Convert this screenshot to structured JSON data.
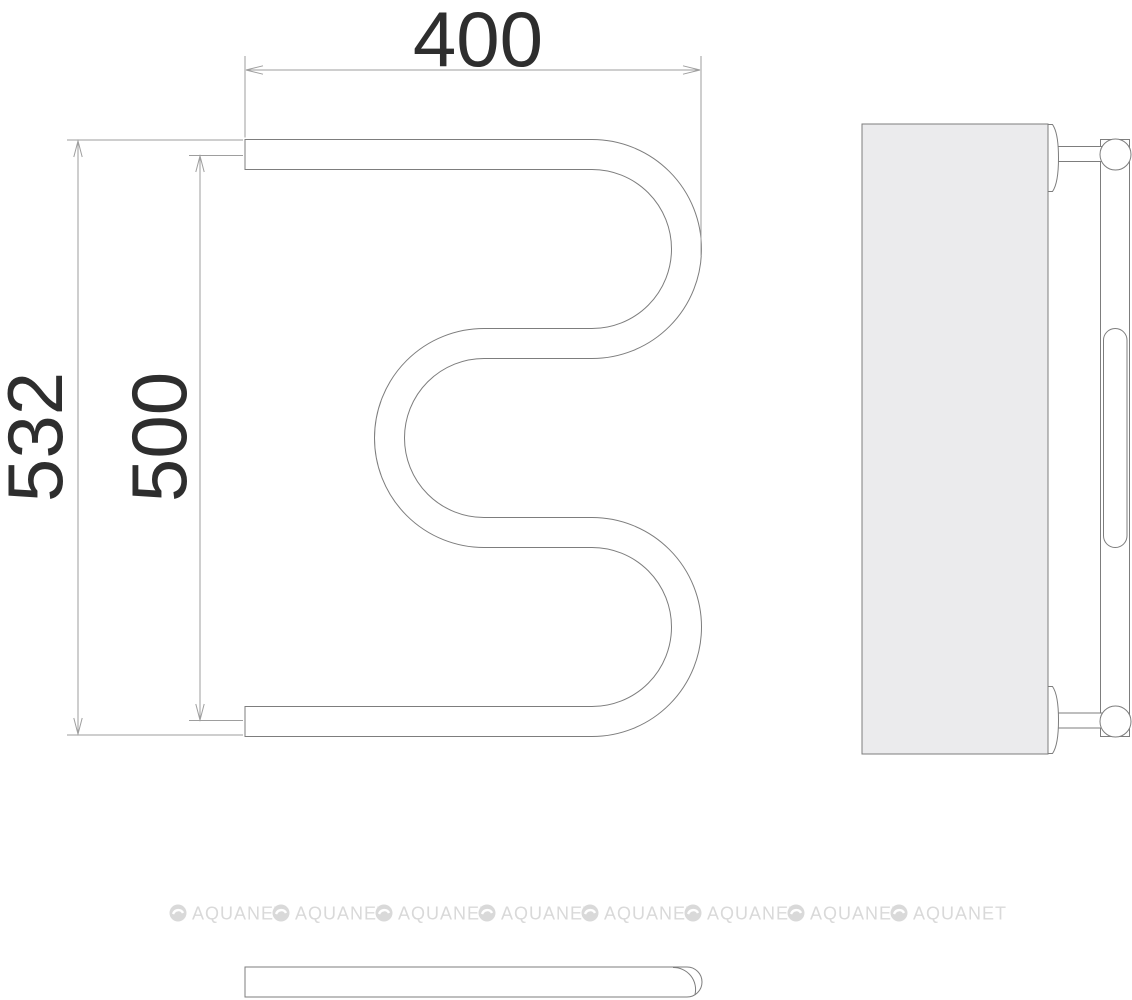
{
  "dimensions": {
    "top_width": "400",
    "overall_height": "532",
    "rail_spacing": "500"
  },
  "watermark": {
    "text": "AQUANET",
    "icon": "aquanet-disc-icon",
    "count": 8,
    "color": "#d9d9d9"
  },
  "colors": {
    "object_line": "#7d7d7d",
    "dimension_line": "#9e9e9e",
    "panel_fill": "#ebebed",
    "dimension_text": "#2e2e2e",
    "watermark": "#d9d9d9",
    "background": "#ffffff"
  }
}
